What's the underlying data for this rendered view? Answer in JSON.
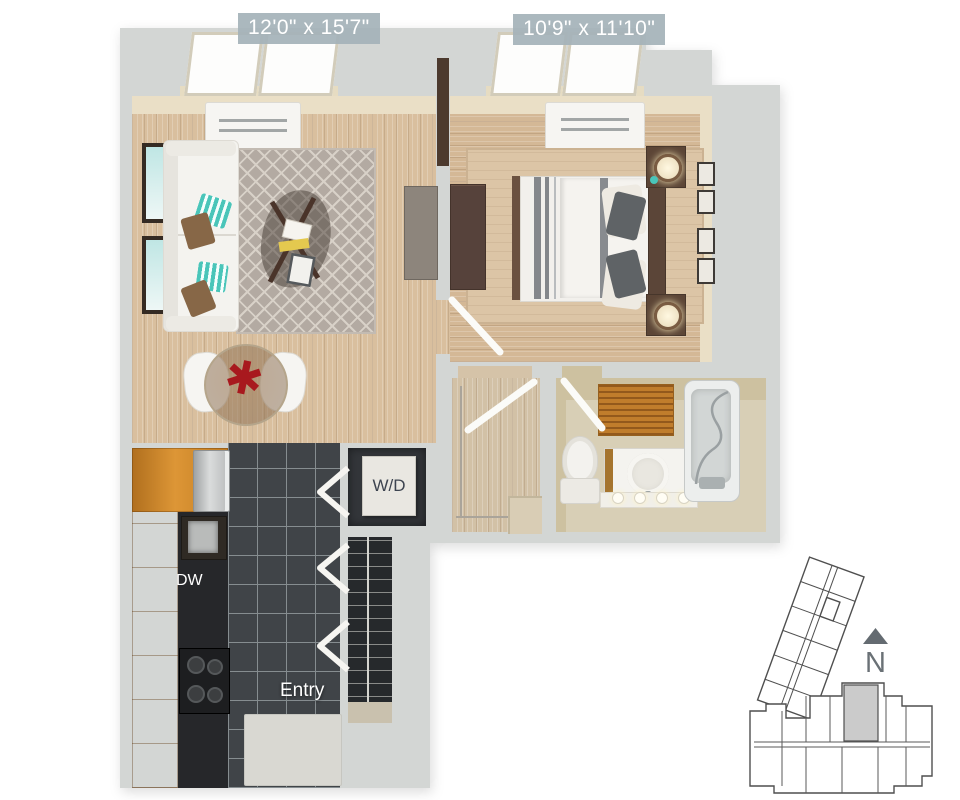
{
  "labels": {
    "living_room_dimensions": "12'0\" x 15'7\"",
    "bedroom_dimensions": "10'9\" x 11'10\"",
    "dishwasher": "DW",
    "entry": "Entry",
    "washer_dryer": "W/D"
  },
  "keyplan": {
    "north_label": "N"
  },
  "colors": {
    "dimension_label_bg": "#a4b2b9",
    "dimension_label_text": "#ffffff",
    "wall_gray": "#d3d6d4",
    "inner_wall_beige": "#eadfc6",
    "wood_floor": "#d9bf9e",
    "kitchen_tile_dark": "#404448",
    "cabinet_wood_orange": "#cd8830",
    "living_rug_gray": "#b3aaa2",
    "bedroom_rug_tan": "#dcc5a6",
    "accent_pillow_teal": "#49c5b9",
    "accent_centerpiece_red": "#a8191e",
    "bath_mat_orange": "#c07d2c",
    "dark_wood_furniture": "#5b4538",
    "keyplan_outline": "#4f4f4f",
    "keyplan_unit_fill": "#cbcbcb",
    "north_arrow_gray": "#646b71"
  }
}
